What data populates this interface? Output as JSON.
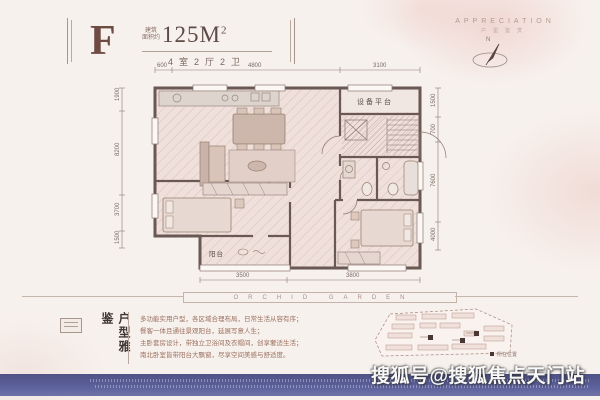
{
  "header": {
    "unit": "F",
    "area_prefix_l1": "建筑",
    "area_prefix_l2": "面积约",
    "area": "125M",
    "area_sup": "2",
    "layout": "4室2厅2卫"
  },
  "appreciation": {
    "en": "APPRECIATION",
    "cn": "户型鉴赏",
    "north": "N"
  },
  "plan": {
    "room_equipment": "设备平台",
    "room_balcony": "阳台",
    "dim_top_1": "600",
    "dim_top_2": "4800",
    "dim_top_3": "3100",
    "dim_bottom_1": "3500",
    "dim_bottom_2": "3800",
    "dim_left_1": "1900",
    "dim_left_2": "8200",
    "dim_left_3": "3700",
    "dim_left_4": "1500",
    "dim_right_1": "1500",
    "dim_right_2": "700",
    "dim_right_3": "7600",
    "dim_right_4": "4000"
  },
  "divider": {
    "text": "ORCHID GARDEN"
  },
  "notes": {
    "title": "户型雅鉴",
    "line1": "多功能实用户型，各区域合理布局，日常生活从容有序；",
    "line2": "餐客一体且通往景观阳台，延展写意人生；",
    "line3": "主卧套房设计，带独立卫浴间及衣帽间，创享奢适生活；",
    "line4": "南北卧室皆带阳台大飘窗，尽享空间美感与舒适度。"
  },
  "siteplan": {
    "legend": "所在位置"
  },
  "watermark": {
    "text": "搜狐号@搜狐焦点天门站"
  },
  "colors": {
    "accent": "#6f4c43",
    "wall": "#6a5854",
    "band": "#565a8e"
  }
}
